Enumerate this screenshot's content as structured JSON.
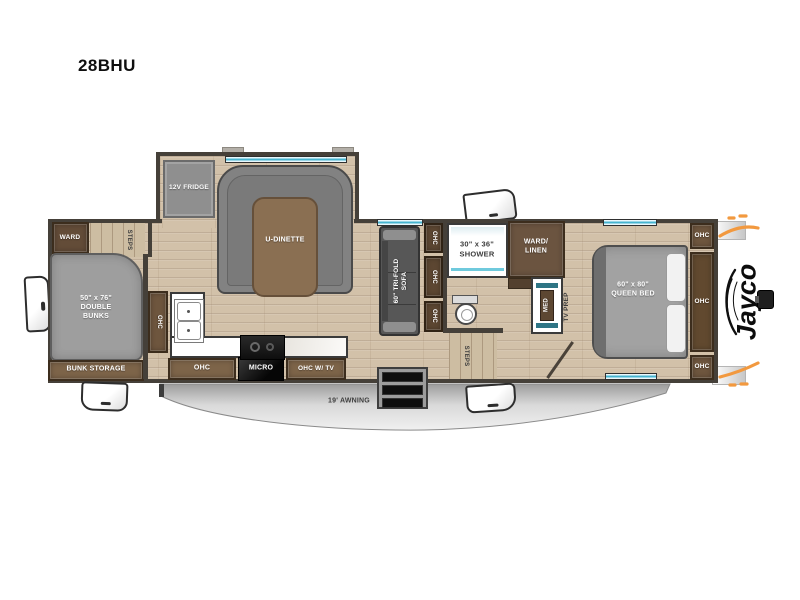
{
  "title": "28BHU",
  "slideout": {
    "fridge": "12V FRIDGE",
    "dinette": "U-DINETTE"
  },
  "bunkroom": {
    "ward": "WARD",
    "steps": "STEPS",
    "bunks_size": "50\" x 76\"",
    "bunks_l2": "DOUBLE",
    "bunks_l3": "BUNKS",
    "storage": "BUNK STORAGE"
  },
  "kitchen": {
    "ohc_side": "OHC",
    "ohc_lower": "OHC",
    "micro": "MICRO",
    "ohc_tv": "OHC W/ TV"
  },
  "living": {
    "sofa_l1": "60\" TRI-FOLD",
    "sofa_l2": "SOFA",
    "ohc_1": "OHC",
    "ohc_2": "OHC",
    "ohc_3": "OHC"
  },
  "bath": {
    "shower_size": "30\" x 36\"",
    "shower": "SHOWER",
    "ward_linen_l1": "WARD/",
    "ward_linen_l2": "LINEN",
    "med": "MED",
    "steps": "STEPS"
  },
  "bedroom": {
    "tv_prep": "TV PREP",
    "bed_size": "60\" x 80\"",
    "bed": "QUEEN BED",
    "ohc_top": "OHC",
    "ohc_mid": "OHC",
    "ohc_bottom": "OHC"
  },
  "exterior": {
    "awning": "19' AWNING",
    "brand": "Jayco"
  },
  "colors": {
    "wall": "#454039",
    "cabinet_brown": "#6e563e",
    "window_teal": "#46b4cf",
    "accent_orange": "#f2993f",
    "awning_silver": "#d9d9d9"
  }
}
